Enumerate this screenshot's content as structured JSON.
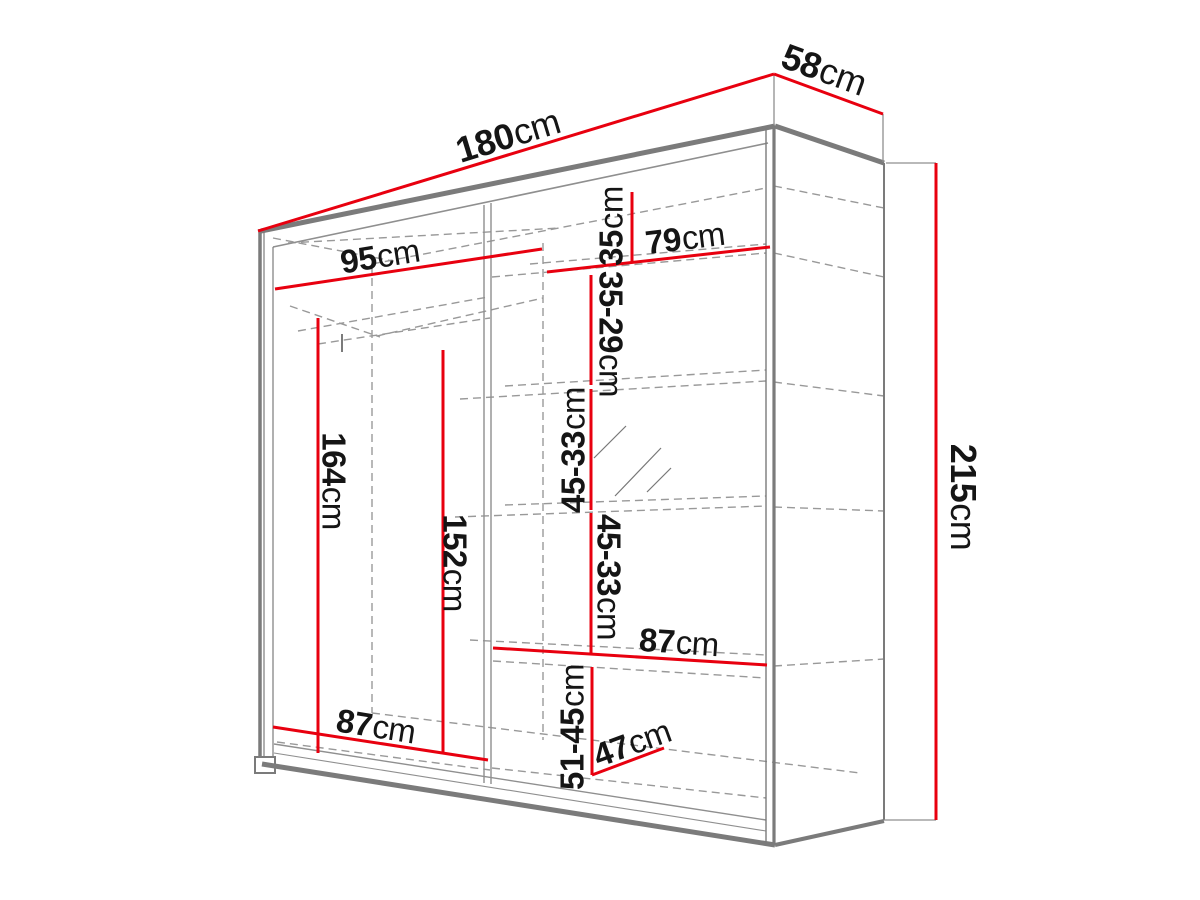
{
  "diagram": {
    "kind": "wardrobe-dimension-drawing",
    "unit": "cm",
    "colors": {
      "dimension_line": "#e8000f",
      "outline": "#7b7b7b",
      "hidden_edge": "#999999",
      "label_text": "#151515",
      "background": "#ffffff"
    }
  },
  "labels": {
    "width": {
      "value": "180",
      "unit": "cm"
    },
    "depth": {
      "value": "58",
      "unit": "cm"
    },
    "height": {
      "value": "215",
      "unit": "cm"
    },
    "left_section_width": {
      "value": "95",
      "unit": "cm"
    },
    "right_section_width": {
      "value": "79",
      "unit": "cm"
    },
    "top_shelf_gap": {
      "value": "35",
      "unit": "cm"
    },
    "shelf_gap_1": {
      "value": "35-29",
      "unit": "cm"
    },
    "shelf_gap_2": {
      "value": "45-33",
      "unit": "cm"
    },
    "shelf_gap_3": {
      "value": "45-33",
      "unit": "cm"
    },
    "bottom_shelf_gap": {
      "value": "51-45",
      "unit": "cm"
    },
    "left_hanging_height": {
      "value": "164",
      "unit": "cm"
    },
    "right_hanging_height": {
      "value": "152",
      "unit": "cm"
    },
    "middle_shelf_width": {
      "value": "87",
      "unit": "cm"
    },
    "bottom_left_width": {
      "value": "87",
      "unit": "cm"
    },
    "bottom_depth": {
      "value": "47",
      "unit": "cm"
    }
  }
}
